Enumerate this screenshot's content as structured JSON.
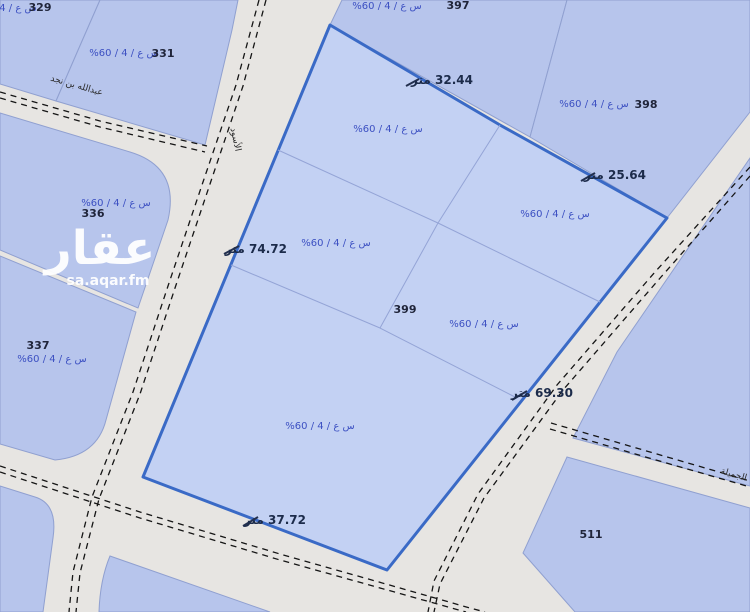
{
  "watermark": {
    "logo": "عقار",
    "site": "sa.aqar.fm"
  },
  "parcels": {
    "p329": {
      "number": "329",
      "zoning": "س ع / 4 / 60%"
    },
    "p331": {
      "number": "331",
      "zoning": "س ع / 4 / 60%"
    },
    "p336": {
      "number": "336",
      "zoning": "س ع / 4 / 60%"
    },
    "p337": {
      "number": "337",
      "zoning": "س ع / 4 / 60%"
    },
    "p397": {
      "number": "397",
      "zoning": "س ع / 4 / 60%"
    },
    "p398": {
      "number": "398",
      "zoning": "س ع / 4 / 60%"
    },
    "p511": {
      "number": "511"
    }
  },
  "selected_parcel": {
    "number": "399",
    "lot_zonings": [
      "س ع / 4 / 60%",
      "س ع / 4 / 60%",
      "س ع / 4 / 60%",
      "س ع / 4 / 60%",
      "س ع / 4 / 60%"
    ],
    "measurements": {
      "top_left_edge": "32.44 متر",
      "top_right_edge": "25.64 متر",
      "right_edge": "69.30 متر",
      "bottom_edge": "37.72 متر",
      "left_edge": "74.72 متر"
    }
  },
  "streets": {
    "northwest": "عبدالله بن نجد",
    "west": "الأسود",
    "southeast": "الجميلة"
  },
  "colors": {
    "selected_outline": "#3a6ac6",
    "selected_fill": "#c3d1f3",
    "parcel_fill": "#b7c5ec",
    "street_fill": "#e7e5e2",
    "zoning_text": "#3c50c2"
  }
}
